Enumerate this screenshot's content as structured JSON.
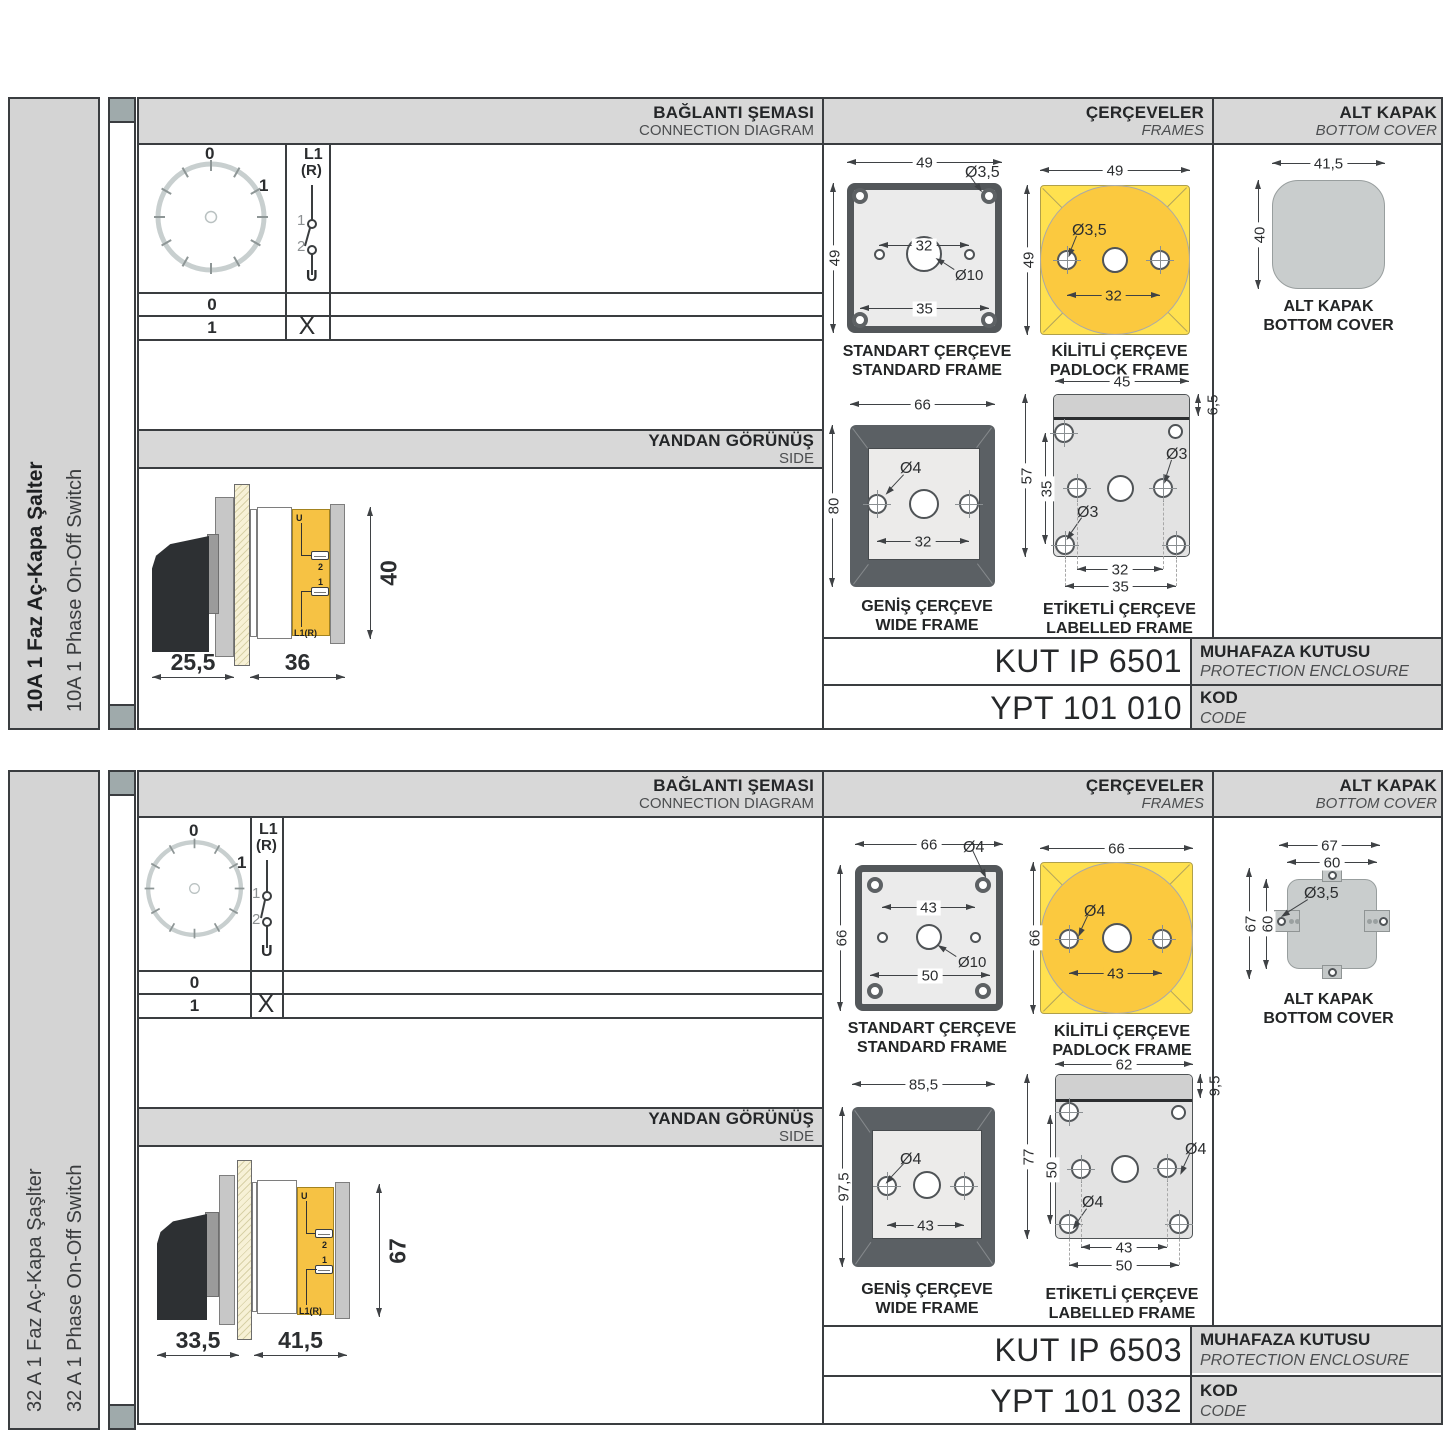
{
  "colors": {
    "band_gray": "#d8d8d8",
    "frame_yellow": "#ffe14f",
    "circle_yellow": "#fbc93f",
    "line_dark": "#3a3d40",
    "cover_gray": "#c9cdcd"
  },
  "sections": [
    {
      "sidebar": {
        "title_tr": "10A 1 Faz Aç-Kapa Şalter",
        "title_en": "10A 1 Phase On-Off Switch"
      },
      "headers": {
        "connection_tr": "BAĞLANTI ŞEMASI",
        "connection_en": "CONNECTION DIAGRAM",
        "frames_tr": "ÇERÇEVELER",
        "frames_en": "FRAMES",
        "cover_tr": "ALT KAPAK",
        "cover_en": "BOTTOM COVER",
        "side_tr": "YANDAN GÖRÜNÜŞ",
        "side_en": "SIDE"
      },
      "diagram": {
        "dial0": "0",
        "dial1": "1",
        "sw_l1": "L1",
        "sw_r": "(R)",
        "sw_c1": "1",
        "sw_c2": "2",
        "sw_u": "U",
        "rows": [
          {
            "pos": "0",
            "mark": ""
          },
          {
            "pos": "1",
            "mark": "X"
          }
        ]
      },
      "side_view": {
        "dim_a": "25,5",
        "dim_b": "36",
        "dim_h": "40",
        "lbl_u": "U",
        "lbl_2": "2",
        "lbl_1": "1",
        "lbl_l1r": "L1(R)"
      },
      "frames": {
        "standard": {
          "title_tr": "STANDART ÇERÇEVE",
          "title_en": "STANDARD FRAME",
          "w": "49",
          "h": "49",
          "hole": "Ø3,5",
          "inner": "32",
          "lower": "35",
          "center": "Ø10"
        },
        "padlock": {
          "title_tr": "KİLİTLİ ÇERÇEVE",
          "title_en": "PADLOCK FRAME",
          "w": "49",
          "h": "49",
          "hole": "Ø3,5",
          "inner": "32"
        },
        "wide": {
          "title_tr": "GENİŞ ÇERÇEVE",
          "title_en": "WIDE FRAME",
          "w": "66",
          "h": "80",
          "hole": "Ø4",
          "inner": "32"
        },
        "labelled": {
          "title_tr": "ETİKETLİ ÇERÇEVE",
          "title_en": "LABELLED FRAME",
          "w": "45",
          "strip": "6,5",
          "h": "57",
          "inner_h": "35",
          "hole1": "Ø3",
          "hole2": "Ø3",
          "inner": "32",
          "lower": "35"
        }
      },
      "cover": {
        "title_tr": "ALT KAPAK",
        "title_en": "BOTTOM COVER",
        "w": "41,5",
        "h": "40"
      },
      "enclosure": {
        "value": "KUT IP 6501",
        "label_tr": "MUHAFAZA KUTUSU",
        "label_en": "PROTECTION ENCLOSURE"
      },
      "code": {
        "value": "YPT 101 010",
        "label_tr": "KOD",
        "label_en": "CODE"
      }
    },
    {
      "sidebar": {
        "title_tr": "32 A 1 Faz Aç-Kapa Şaşlter",
        "title_en": "32 A 1 Phase On-Off Switch"
      },
      "headers": {
        "connection_tr": "BAĞLANTI ŞEMASI",
        "connection_en": "CONNECTION DIAGRAM",
        "frames_tr": "ÇERÇEVELER",
        "frames_en": "FRAMES",
        "cover_tr": "ALT KAPAK",
        "cover_en": "BOTTOM COVER",
        "side_tr": "YANDAN GÖRÜNÜŞ",
        "side_en": "SIDE"
      },
      "diagram": {
        "dial0": "0",
        "dial1": "1",
        "sw_l1": "L1",
        "sw_r": "(R)",
        "sw_c1": "1",
        "sw_c2": "2",
        "sw_u": "U",
        "rows": [
          {
            "pos": "0",
            "mark": ""
          },
          {
            "pos": "1",
            "mark": "X"
          }
        ]
      },
      "side_view": {
        "dim_a": "33,5",
        "dim_b": "41,5",
        "dim_h": "67",
        "lbl_u": "U",
        "lbl_2": "2",
        "lbl_1": "1",
        "lbl_l1r": "L1(R)"
      },
      "frames": {
        "standard": {
          "title_tr": "STANDART ÇERÇEVE",
          "title_en": "STANDARD FRAME",
          "w": "66",
          "h": "66",
          "hole": "Ø4",
          "inner": "43",
          "lower": "50",
          "center": "Ø10"
        },
        "padlock": {
          "title_tr": "KİLİTLİ ÇERÇEVE",
          "title_en": "PADLOCK FRAME",
          "w": "66",
          "h": "66",
          "hole": "Ø4",
          "inner": "43"
        },
        "wide": {
          "title_tr": "GENİŞ ÇERÇEVE",
          "title_en": "WIDE FRAME",
          "w": "85,5",
          "h": "97,5",
          "hole": "Ø4",
          "inner": "43"
        },
        "labelled": {
          "title_tr": "ETİKETLİ ÇERÇEVE",
          "title_en": "LABELLED FRAME",
          "w": "62",
          "strip": "9,5",
          "h": "77",
          "inner_h": "50",
          "hole1": "Ø4",
          "hole2": "Ø4",
          "inner": "43",
          "lower": "50"
        }
      },
      "cover": {
        "title_tr": "ALT KAPAK",
        "title_en": "BOTTOM COVER",
        "w_outer": "67",
        "w_inner": "60",
        "h_outer": "67",
        "h_inner": "60",
        "hole": "Ø3,5"
      },
      "enclosure": {
        "value": "KUT IP 6503",
        "label_tr": "MUHAFAZA KUTUSU",
        "label_en": "PROTECTION ENCLOSURE"
      },
      "code": {
        "value": "YPT 101 032",
        "label_tr": "KOD",
        "label_en": "CODE"
      }
    }
  ]
}
